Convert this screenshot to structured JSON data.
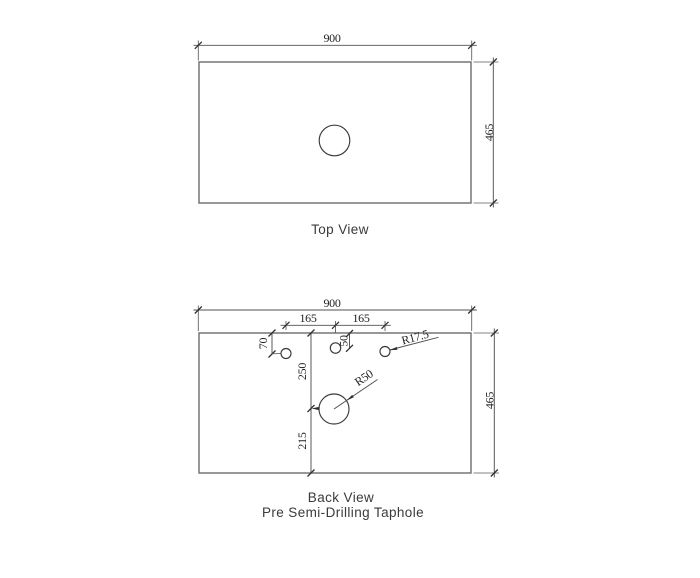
{
  "top_view": {
    "label": "Top View",
    "width_dim": "900",
    "height_dim": "465"
  },
  "back_view": {
    "label": "Back View",
    "subtitle": "Pre Semi-Drilling Taphole",
    "width_dim": "900",
    "height_dim": "465",
    "hole_spacing_left": "165",
    "hole_spacing_right": "165",
    "left_hole_top_offset": "70",
    "center_hole_top_offset": "50",
    "main_hole_to_top": "250",
    "main_hole_to_bottom": "215",
    "side_hole_radius": "R17.5",
    "main_hole_radius": "R50"
  },
  "colors": {
    "background": "#ffffff",
    "outline": "#6b6b6b",
    "dimension_line": "#505050",
    "text": "#1f1f1f"
  }
}
